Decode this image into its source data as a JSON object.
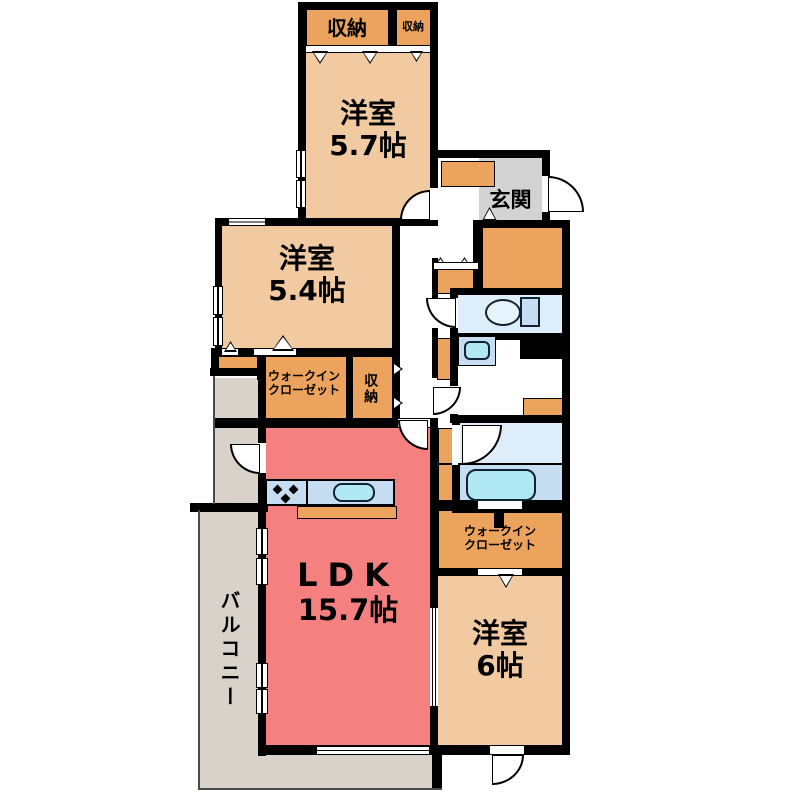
{
  "colors": {
    "wall": "#000000",
    "room_tan": "#f1caa2",
    "closet_orange": "#eba35d",
    "entrance_gray": "#d3d3d3",
    "balcony_gray": "#d9d2ca",
    "ldk_pink": "#f58080",
    "water_light": "#ddedfa",
    "water_mid": "#c6ddf2",
    "fixture_cyan": "#b0e9f4"
  },
  "rooms": {
    "storage_top_left": {
      "label": "収納"
    },
    "storage_top_right": {
      "label": "収納"
    },
    "bedroom_57": {
      "label": "洋室",
      "size": "5.7帖"
    },
    "entrance": {
      "label": "玄関"
    },
    "bedroom_54": {
      "label": "洋室",
      "size": "5.4帖"
    },
    "wic_1": {
      "line1": "ウォークイン",
      "line2": "クローゼット"
    },
    "storage_mid": {
      "label": "収納"
    },
    "ldk": {
      "label": "LDK",
      "size": "15.7帖"
    },
    "balcony": {
      "label": "バルコニー"
    },
    "wic_2": {
      "line1": "ウォークイン",
      "line2": "クローゼット"
    },
    "bedroom_6": {
      "label": "洋室",
      "size": "6帖"
    }
  }
}
